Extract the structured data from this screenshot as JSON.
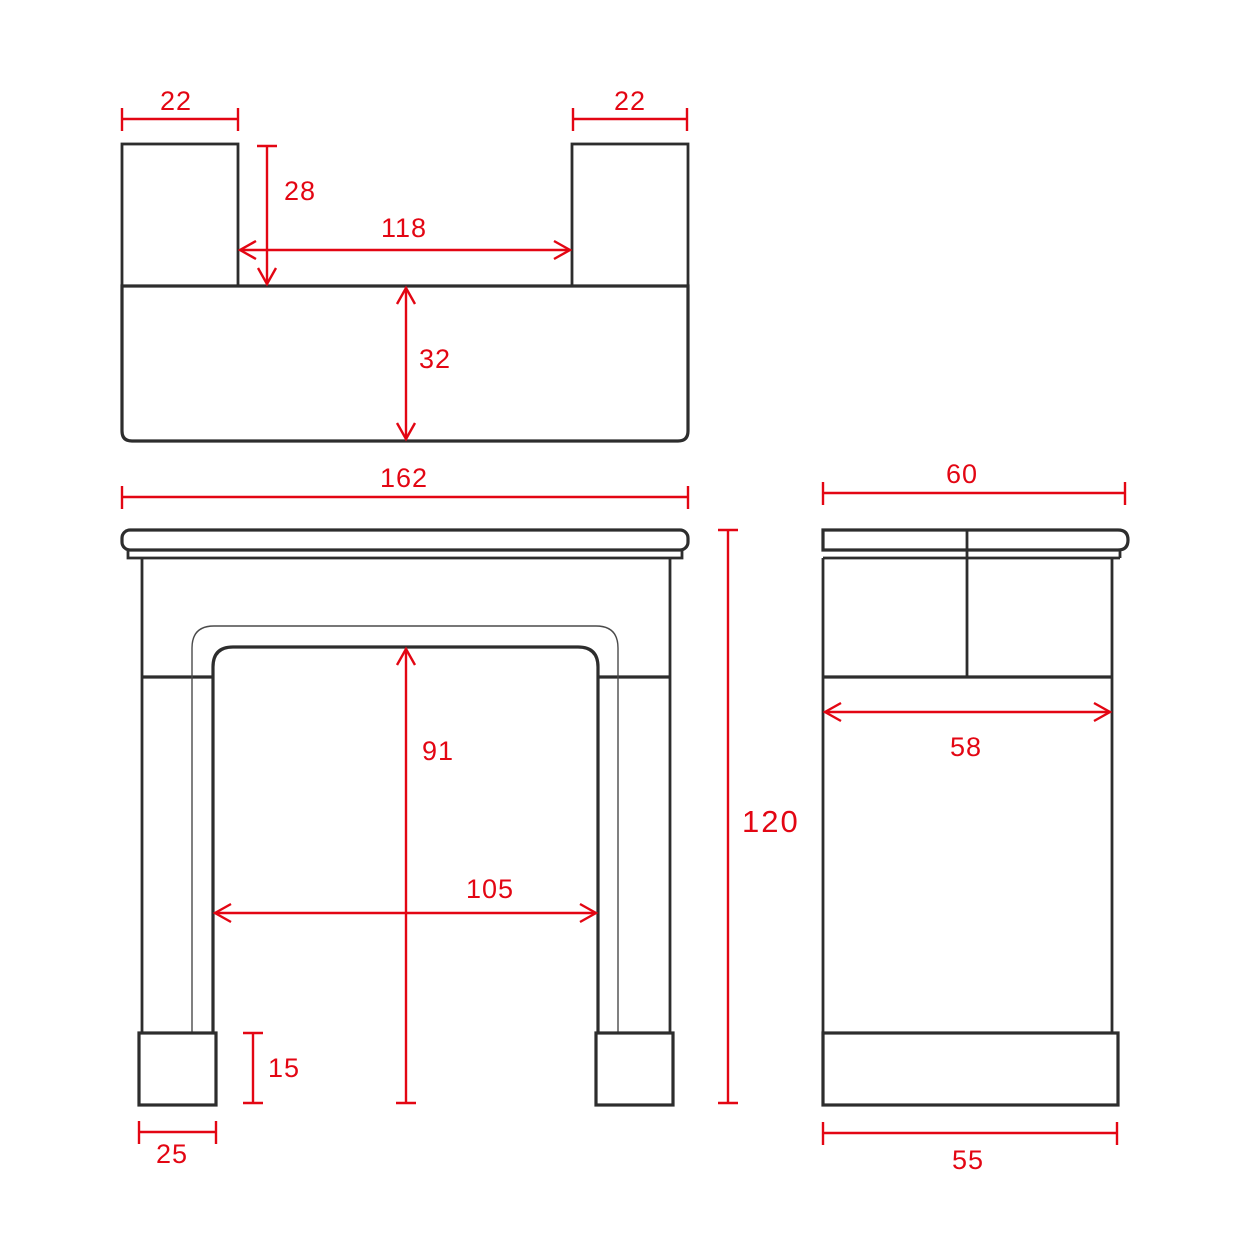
{
  "colors": {
    "dimension_red": "#e30613",
    "outline_black": "#2d2d2d",
    "background": "#ffffff"
  },
  "views": {
    "plan": {
      "dims": {
        "left_leg_width": "22",
        "right_leg_width": "22",
        "leg_depth": "28",
        "inner_width": "118",
        "shelf_depth": "32"
      }
    },
    "front": {
      "dims": {
        "overall_width": "162",
        "overall_height": "120",
        "opening_height": "91",
        "opening_width": "105",
        "plinth_height": "15",
        "plinth_width": "25"
      }
    },
    "side": {
      "dims": {
        "shelf_depth": "60",
        "body_depth": "58",
        "plinth_depth": "55"
      }
    }
  }
}
